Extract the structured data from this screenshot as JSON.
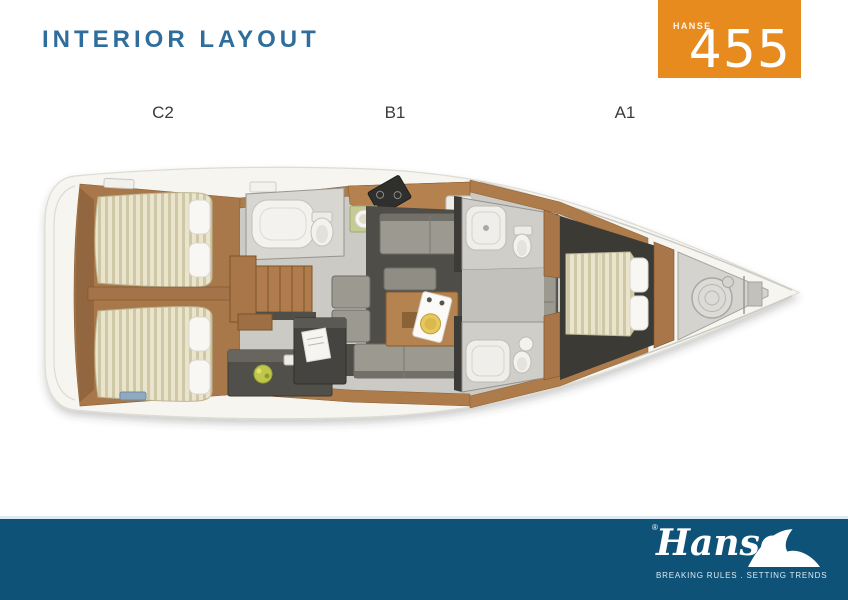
{
  "header": {
    "title": "INTERIOR LAYOUT"
  },
  "model_badge": {
    "brand": "HANSE",
    "model_number": "455"
  },
  "layout_labels": [
    {
      "text": "C2"
    },
    {
      "text": "B1"
    },
    {
      "text": "A1"
    }
  ],
  "footer": {
    "brand_script": "Hanse",
    "registered_mark": "®",
    "tagline": "BREAKING RULES . SETTING TRENDS"
  },
  "colors": {
    "title_blue": "#2F6E9C",
    "badge_orange": "#E88B1E",
    "footer_bar_blue": "#0F5278",
    "hull_white": "#F6F5F0",
    "wood_brown": "#AE7B4B",
    "mattress_cream": "#EAE4CC",
    "mattress_stripe": "#CFC8A6",
    "saloon_sofa_gray": "#9B9990",
    "dark_floor": "#4F4D47",
    "label_gray": "#3B3B3B"
  },
  "icons": {
    "footer_wave": "hanse-wave-icon"
  }
}
